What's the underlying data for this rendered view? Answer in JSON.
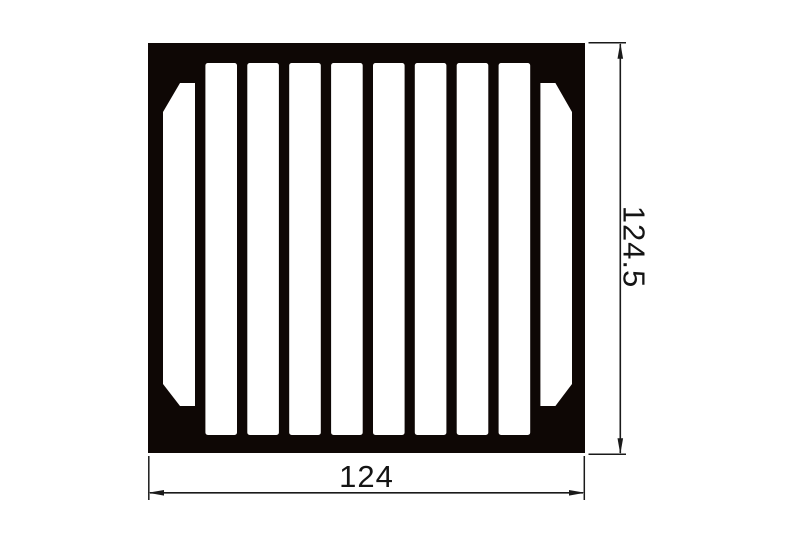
{
  "drawing": {
    "kind": "heatsink-extrusion-cross-section",
    "dimensions": {
      "width_label": "124",
      "height_label": "124.5"
    },
    "profile": {
      "fin_count": 9,
      "slot_count": 10,
      "chamfered_channel_count": 2
    },
    "colors": {
      "ink": "#0e0705",
      "line": "#1a1a1a",
      "background": "#ffffff"
    }
  }
}
